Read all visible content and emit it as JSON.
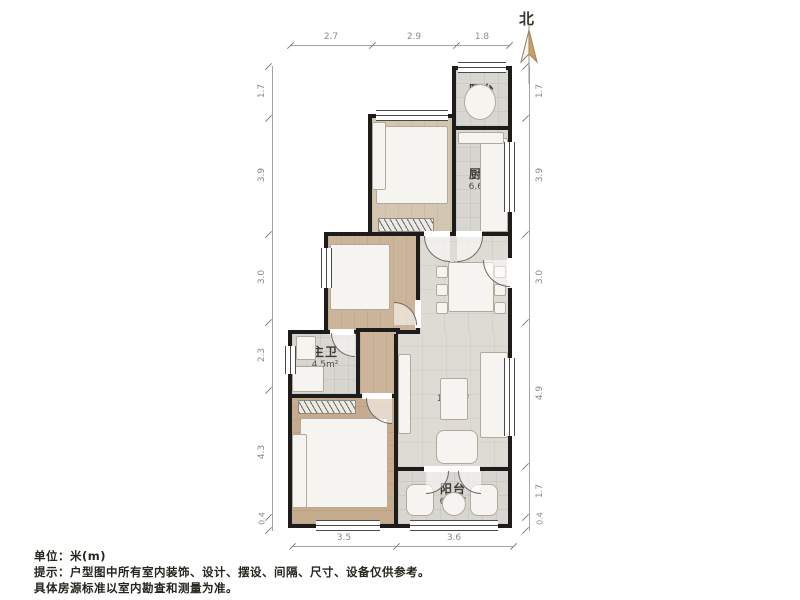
{
  "compass": {
    "label": "北"
  },
  "rooms": {
    "balcony_top": {
      "name": "阳台",
      "area": "2.6m²"
    },
    "bedroom2": {
      "name": "次卧2",
      "area": "10.5m²"
    },
    "kitchen": {
      "name": "厨房",
      "area": "6.6m²"
    },
    "bedroom": {
      "name": "次卧",
      "area": "7.7m²"
    },
    "dining": {
      "name": "餐厅",
      "area": "9.4m²"
    },
    "bath": {
      "name": "主卫",
      "area": "4.5m²"
    },
    "living": {
      "name": "客厅",
      "area": "19.0m²"
    },
    "master": {
      "name": "主卧",
      "area": "16.3m²"
    },
    "balcony_bottom": {
      "name": "阳台",
      "area": "6.1m²"
    }
  },
  "dims": {
    "top": [
      "2.7",
      "2.9",
      "1.8"
    ],
    "bottom": [
      "3.5",
      "3.6"
    ],
    "left": [
      "1.7",
      "3.9",
      "3.0",
      "2.3",
      "4.3",
      "0.4"
    ],
    "right": [
      "1.7",
      "3.9",
      "3.0",
      "4.9",
      "1.7",
      "0.4"
    ]
  },
  "notes": {
    "unit": "单位：米(m)",
    "tip1": "提示：户型图中所有室内装饰、设计、摆设、间隔、尺寸、设备仅供参考。",
    "tip2": "具体房源标准以室内勘查和测量为准。"
  },
  "colors": {
    "wall": "#1d1c1a",
    "needle": "#c9a066"
  }
}
